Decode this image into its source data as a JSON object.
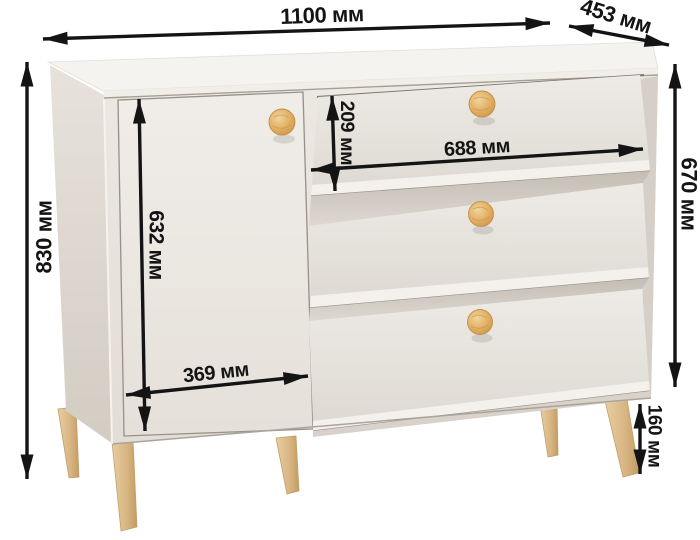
{
  "diagram": {
    "unit": "мм",
    "furniture": {
      "name": "комод",
      "description": "Chest of drawers with one hinged door on the left, three slanted drawer fronts on the right, round wooden knobs and tapered wooden legs",
      "knob_count": 4,
      "visible_leg_count": 5
    },
    "colors": {
      "background": "#ffffff",
      "cabinet_body": "#eae6e0",
      "cabinet_top": "#f5f3ef",
      "shadow_side": "#d6d0c8",
      "knob_wood": "#e0b066",
      "leg_wood": "#dcbd8d",
      "dimension_lines": "#141414"
    },
    "dimensions": {
      "overall_width": {
        "label": "1100 мм",
        "value": 1100,
        "placement": "top edge, horizontal"
      },
      "depth": {
        "label": "453 мм",
        "value": 453,
        "placement": "top right, diagonal along depth"
      },
      "overall_height": {
        "label": "830 мм",
        "value": 830,
        "placement": "far left, vertical, floor to top"
      },
      "body_height": {
        "label": "670 мм",
        "value": 670,
        "placement": "right side, vertical, body without legs"
      },
      "door_height": {
        "label": "632 мм",
        "value": 632,
        "placement": "on the door, vertical"
      },
      "drawer_front_height": {
        "label": "209 мм",
        "value": 209,
        "placement": "top drawer front, vertical"
      },
      "drawer_width": {
        "label": "688 мм",
        "value": 688,
        "placement": "across top drawer, horizontal"
      },
      "door_width": {
        "label": "369 мм",
        "value": 369,
        "placement": "door bottom, horizontal"
      },
      "leg_height": {
        "label": "160 мм",
        "value": 160,
        "placement": "front right leg, vertical"
      }
    }
  }
}
